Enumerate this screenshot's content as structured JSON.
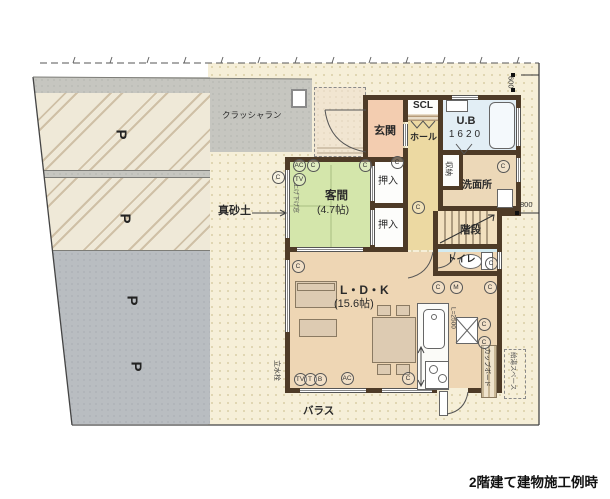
{
  "caption": "2階建て建物施工例時",
  "site": {
    "crusher_run": "クラッシャラン",
    "masado": "真砂土",
    "ballast": "バラス",
    "water_tap": "立水栓",
    "parking_mark": "P",
    "p_marks": [
      {
        "x": 116,
        "y": 126
      },
      {
        "x": 120,
        "y": 210
      },
      {
        "x": 127,
        "y": 292
      },
      {
        "x": 131,
        "y": 358
      }
    ]
  },
  "rooms": {
    "genkan": "玄関",
    "scl": "SCL",
    "hall": "ホール",
    "ub": "U.B",
    "ub_size": "1620",
    "oshiire1": "押入",
    "oshiire2": "押入",
    "kyakuma": "客間",
    "kyakuma_size": "(4.7帖)",
    "senmenjo": "洗面所",
    "shuno": "収納",
    "kaidan": "階段",
    "toilet": "トイレ",
    "ldk": "L・D・K",
    "ldk_size": "(15.6帖)",
    "cupboard": "カップボード",
    "kyuto_space": "給湯スペース",
    "counter_length": "L=2500",
    "window_note": "上げ下げ窓"
  },
  "dimensions": {
    "top_right": "600",
    "right_side": "800"
  },
  "symbols": [
    {
      "t": "C",
      "x": 278,
      "y": 177
    },
    {
      "t": "AC",
      "x": 299,
      "y": 165
    },
    {
      "t": "C",
      "x": 313,
      "y": 165
    },
    {
      "t": "TV",
      "x": 299,
      "y": 179
    },
    {
      "t": "C",
      "x": 365,
      "y": 165
    },
    {
      "t": "C",
      "x": 397,
      "y": 162
    },
    {
      "t": "C",
      "x": 418,
      "y": 207
    },
    {
      "t": "C",
      "x": 298,
      "y": 266
    },
    {
      "t": "C",
      "x": 438,
      "y": 287
    },
    {
      "t": "M",
      "x": 456,
      "y": 287
    },
    {
      "t": "C",
      "x": 490,
      "y": 287
    },
    {
      "t": "C",
      "x": 503,
      "y": 166
    },
    {
      "t": "C",
      "x": 491,
      "y": 263
    },
    {
      "t": "C",
      "x": 484,
      "y": 324
    },
    {
      "t": "C",
      "x": 484,
      "y": 342
    },
    {
      "t": "TV",
      "x": 300,
      "y": 379
    },
    {
      "t": "T",
      "x": 310,
      "y": 379
    },
    {
      "t": "B",
      "x": 320,
      "y": 379
    },
    {
      "t": "AC",
      "x": 347,
      "y": 378
    },
    {
      "t": "C",
      "x": 408,
      "y": 378
    }
  ],
  "colors": {
    "wall": "#4e3b27",
    "site": "#f6efd8",
    "crusher_gray": "#c6c6c0",
    "parking_gray": "#b9bdc1",
    "tatami_green": "#d4e6ab",
    "ldk_tan": "#eed6b4",
    "genkan_pink": "#f3cdb0",
    "hall_yellow": "#ecd9a2",
    "bath_blue": "#e2eef5",
    "toilet_blue": "#d3ebf1"
  }
}
